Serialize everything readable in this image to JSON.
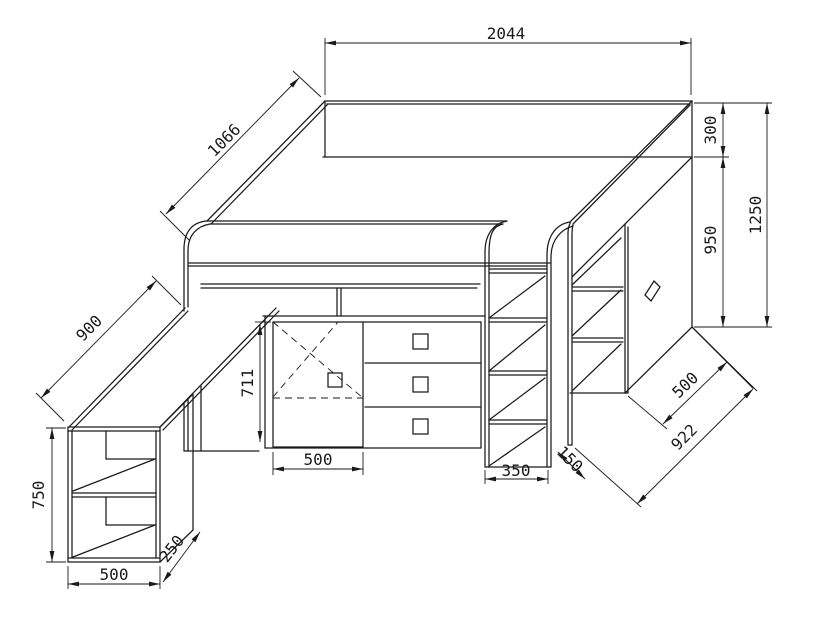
{
  "drawing": {
    "subject": "loft-bed-with-desk-technical-drawing",
    "units": "mm",
    "colors": {
      "line": "#1a1a1a",
      "background": "#ffffff"
    },
    "dims": {
      "bed_length": "2044",
      "bed_depth": "1066",
      "rail_height": "300",
      "wardrobe_height": "950",
      "total_height": "1250",
      "desk_depth": "900",
      "cabinet_height": "711",
      "cabinet_width": "500",
      "ladder_width": "350",
      "ladder_depth": "150",
      "bookcase_height": "750",
      "bookcase_width": "500",
      "bookcase_depth": "250",
      "wardrobe_depth": "500",
      "footprint_depth": "922"
    }
  }
}
